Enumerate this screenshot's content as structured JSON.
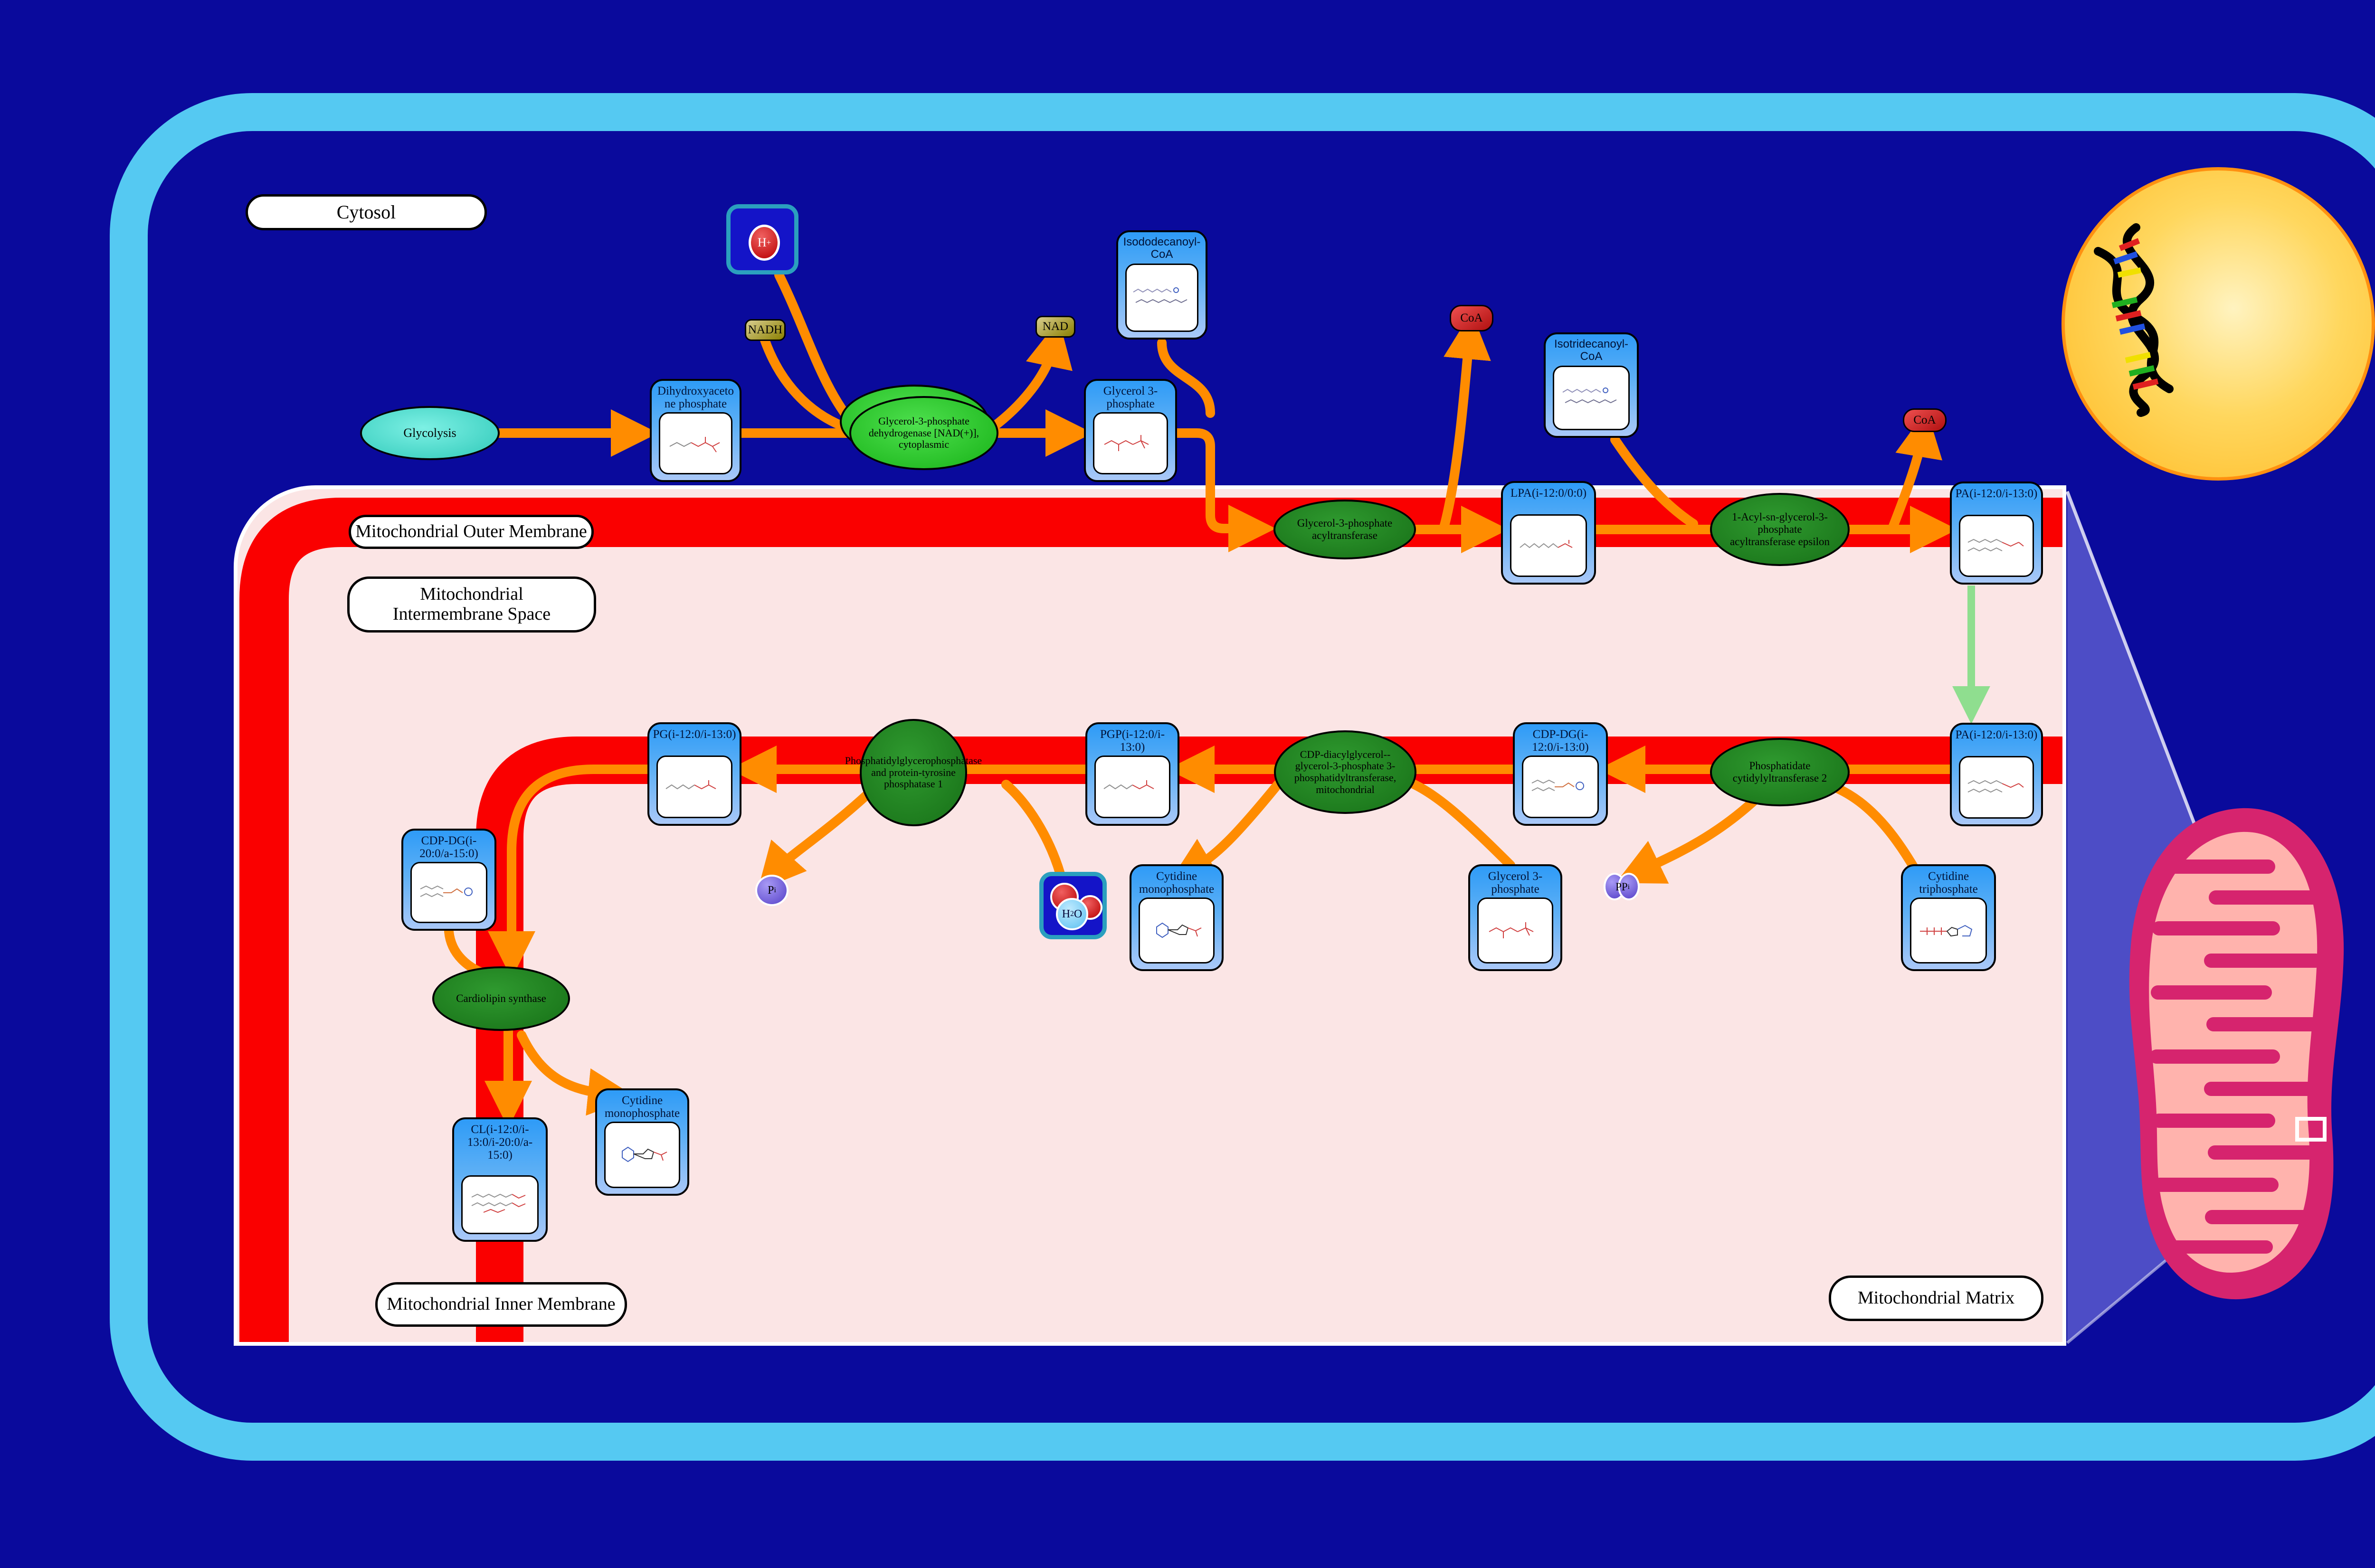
{
  "labels": {
    "cytosol": "Cytosol",
    "outer_membrane": "Mitochondrial Outer Membrane",
    "intermembrane": "Mitochondrial Intermembrane Space",
    "inner_membrane": "Mitochondrial Inner Membrane",
    "matrix": "Mitochondrial Matrix"
  },
  "pathway_nodes": {
    "glycolysis": "Glycolysis"
  },
  "metabolites": {
    "dhap": "Dihydroxyacetone phosphate",
    "g3p_cytosol": "Glycerol 3-phosphate",
    "isododecanoyl_coa": "Isododecanoyl-CoA",
    "isotridecanoyl_coa": "Isotridecanoyl-CoA",
    "lpa": "LPA(i-12:0/0:0)",
    "pa_outer": "PA(i-12:0/i-13:0)",
    "pa_inner": "PA(i-12:0/i-13:0)",
    "cdp_dg": "CDP-DG(i-12:0/i-13:0)",
    "pgp": "PGP(i-12:0/i-13:0)",
    "pg": "PG(i-12:0/i-13:0)",
    "cdp_dg_2": "CDP-DG(i-20:0/a-15:0)",
    "cl": "CL(i-12:0/i-13:0/i-20:0/a-15:0)",
    "cmp_matrix": "Cytidine monophosphate",
    "cmp_bottom": "Cytidine monophosphate",
    "g3p_matrix": "Glycerol 3-phosphate",
    "ctp": "Cytidine triphosphate"
  },
  "enzymes": {
    "gpd_cytoplasmic": "Glycerol-3-phosphate dehydrogenase [NAD(+)], cytoplasmic",
    "gpat": "Glycerol-3-phosphate acyltransferase",
    "agpat_epsilon": "1-Acyl-sn-glycerol-3-phosphate acyltransferase epsilon",
    "pct2": "Phosphatidate cytidylyltransferase 2",
    "cdgs": "CDP-diacylglycerol--glycerol-3-phosphate 3-phosphatidyltransferase, mitochondrial",
    "pgpase": "Phosphatidylglycerophosphatase and protein-tyrosine phosphatase 1",
    "cls": "Cardiolipin synthase"
  },
  "cofactors": {
    "nadh": "NADH",
    "nad": "NAD",
    "coa_left": "CoA",
    "coa_right": "CoA",
    "h_base": "H",
    "h_sup": "+",
    "pi_base": "P",
    "pi_sub": "i",
    "ppi_base": "PP",
    "ppi_sub": "i",
    "h2o_h": "H",
    "h2o_2": "2",
    "h2o_o": "O"
  },
  "colors": {
    "background_navy": "#0a0a9c",
    "cell_border_blue": "#55c9f2",
    "membrane_red": "#fa0000",
    "region_pink": "#fbe5e5",
    "metabolite_blue_top": "#2e9bf7",
    "metabolite_blue_bottom": "#a9c8f8",
    "enzyme_green_dark": "#1d7a1d",
    "enzyme_green_bright": "#2ecc2e",
    "arrow_orange": "#ff8c00",
    "arrow_green": "#8fde8f",
    "glycolysis_turquoise": "#40e0d0",
    "nucleus_yellow": "#ffc125",
    "mitochondrion_crimson": "#d6246e",
    "mitochondrion_matrix_pink": "#ffb3ad",
    "cofactor_khaki": "#b5a642",
    "cofactor_red": "#d42020",
    "phosphate_purple": "#6a55d8"
  }
}
